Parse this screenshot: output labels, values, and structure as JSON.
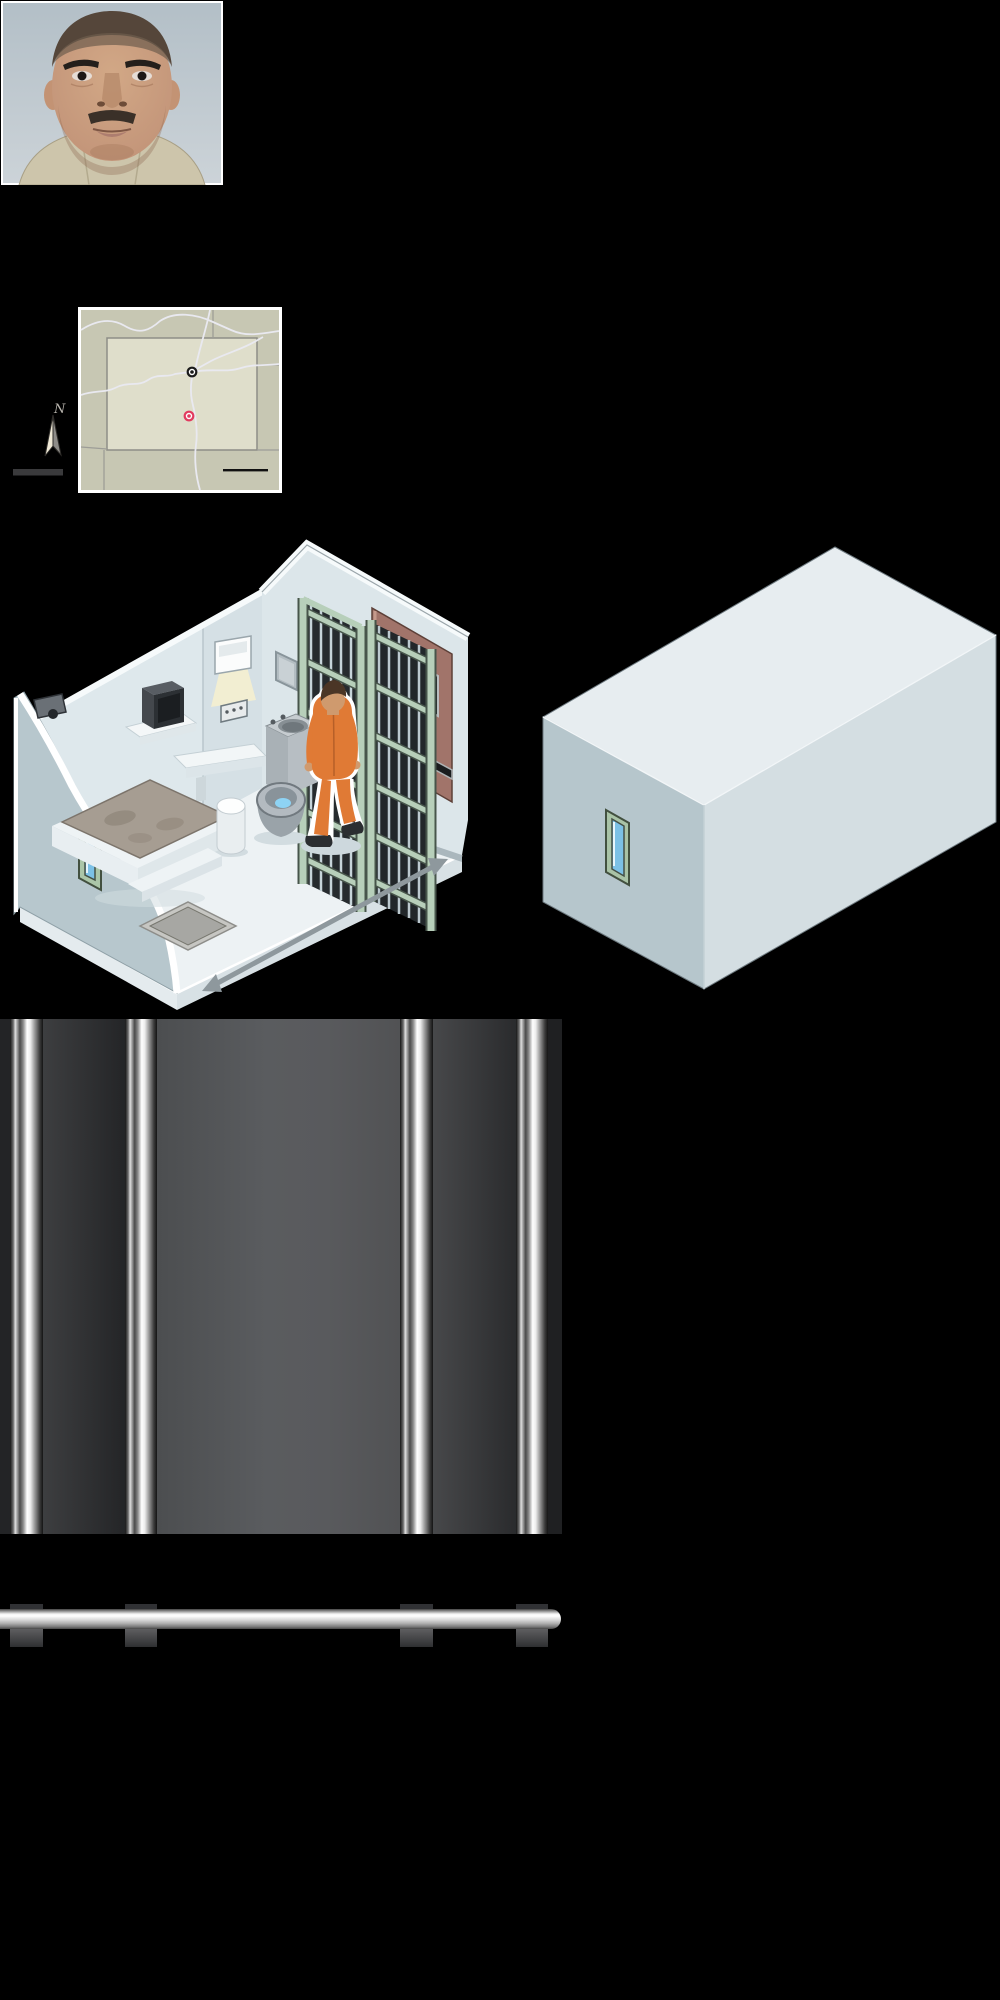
{
  "page": {
    "background": "#000000",
    "width": 1000,
    "height": 2000
  },
  "booking_photo": {
    "description": "mug shot close-up of a middle-aged man, buzz-cut dark hair, dark eyebrows and mustache, khaki prison shirt, pale blue-gray backdrop, thin white frame",
    "frame_color": "#ffffff",
    "backdrop_color": "#b9c4cb",
    "skin_color": "#c89d7f",
    "shirt_color": "#cdc5ab",
    "hair_color": "#55463a"
  },
  "locator_map": {
    "description": "state locator map (Colorado region) with two place markers, highways, scale bar and north compass",
    "compass_label": "N",
    "outer_region_color": "#c7c7b3",
    "state_fill_color": "#dfdecb",
    "border_color": "#8d8d87",
    "road_color": "#e9e9f0",
    "frame_color": "#ffffff",
    "scale_bar_color": "#111111",
    "legend_bar_color": "#3a3a3c",
    "markers": [
      {
        "name": "city-marker",
        "color": "#1a1a1a"
      },
      {
        "name": "prison-marker",
        "color": "#e23a5f"
      }
    ]
  },
  "cell_cutaway": {
    "description": "isometric cutaway of a supermax prison cell: inmate in orange jumpsuit facing sliding barred gates and a brown solid door; concrete bed with gray mattress, shower tray, stool, desk, TV on shelf, combined steel toilet-sink, polished steel mirror, recessed light with button panel, security camera, narrow window slit; gray double-headed dimension arrow along the front floor edge",
    "wall_color": "#d8e2e7",
    "floor_color": "#edf2f4",
    "cutaway_wall_color": "#b7c7cd",
    "bar_frame_color": "#b7cfba",
    "bar_color": "#c6d4d9",
    "door_color": "#a1746a",
    "jumpsuit_color": "#e07a35",
    "mattress_color": "#a69d92",
    "steel_color": "#b3bac0",
    "water_color": "#8ed3f4",
    "glow_color": "#f5f0cf",
    "arrow_color": "#8e989d"
  },
  "cell_exterior": {
    "description": "sealed isometric concrete box (cell exterior) with a single narrow window slit on the left face",
    "top_face_color": "#e7edf0",
    "left_face_color": "#b6c6cc",
    "right_face_color": "#d4dee2",
    "window_frame_color": "#a9c3a6",
    "window_glass_color": "#7cc1e6"
  },
  "bars_graphic": {
    "description": "four vertical chrome prison bars over a dark gray gradient backdrop",
    "backdrop_color": "#55575a",
    "bar_highlight_color": "#ffffff",
    "bar_shadow_color": "#141414"
  },
  "rail_graphic": {
    "description": "horizontal polished steel rail with rounded right end; dark bar stubs pass behind it at the four bar positions",
    "rail_color": "#d8d8d8",
    "stub_color": "#3a3b3d"
  }
}
